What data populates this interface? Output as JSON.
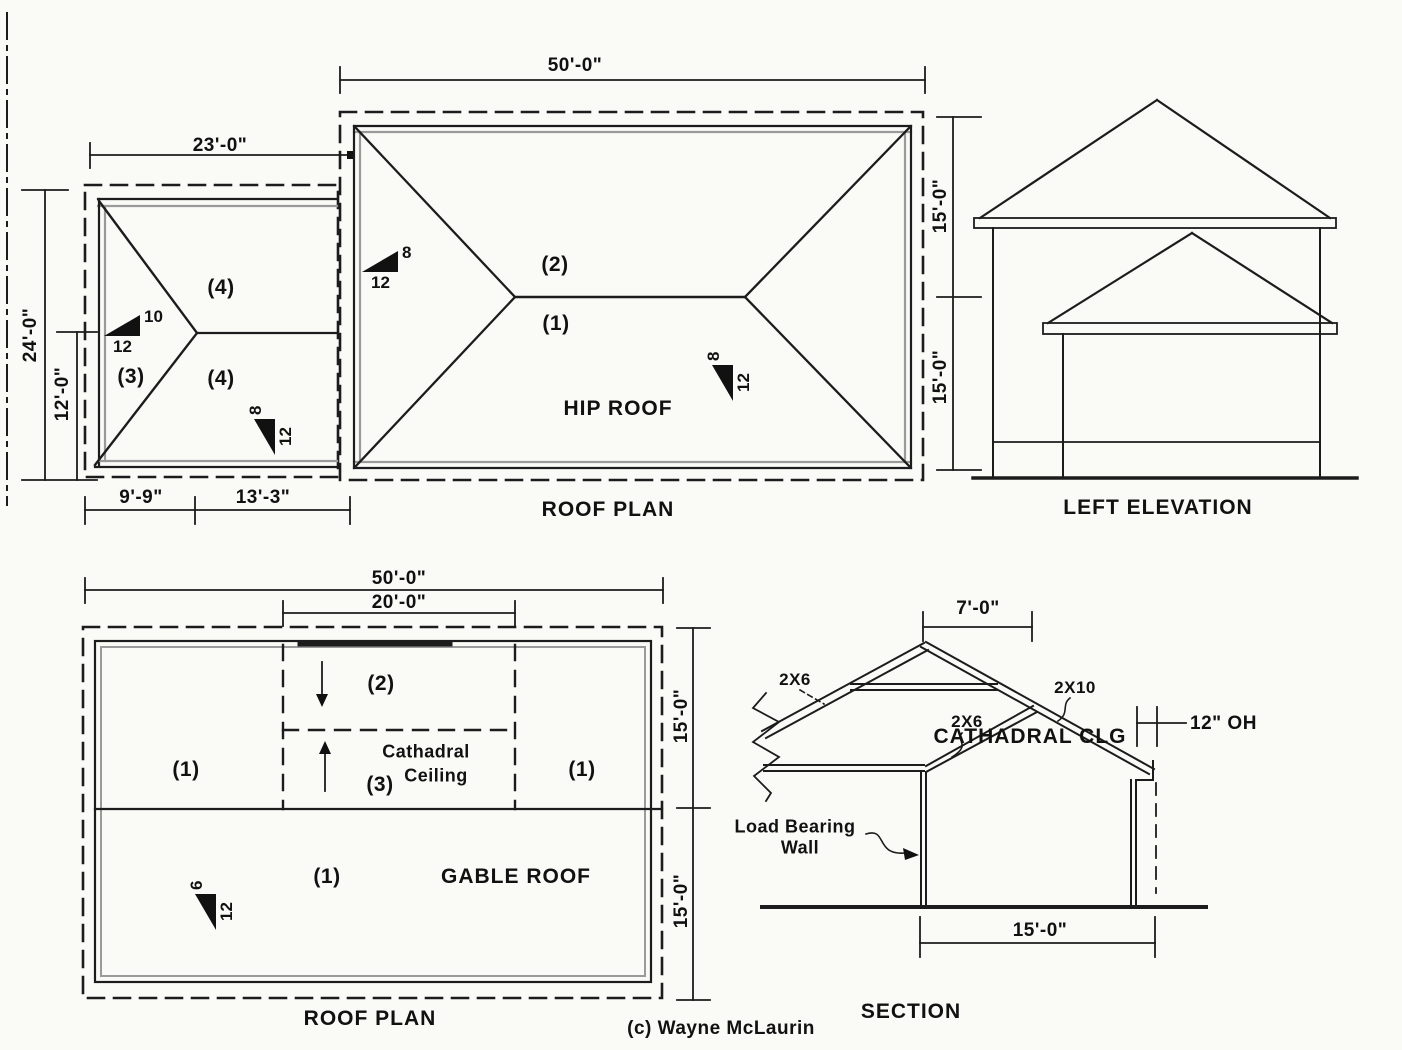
{
  "small_plan": {
    "dim_width": "23'-0\"",
    "dim_total_height": "24'-0\"",
    "dim_lower_height": "12'-0\"",
    "dim_bottom_left": "9'-9\"",
    "dim_bottom_right": "13'-3\"",
    "label_upper": "(4)",
    "label_left": "(3)",
    "label_lower": "(4)",
    "slope_upper": {
      "rise": "10",
      "run": "12"
    },
    "slope_lower": {
      "rise": "8",
      "run": "12"
    }
  },
  "hip_plan": {
    "title": "HIP ROOF",
    "caption": "ROOF PLAN",
    "dim_width": "50'-0\"",
    "dim_right_upper": "15'-0\"",
    "dim_right_lower": "15'-0\"",
    "label_upper": "(2)",
    "label_lower": "(1)",
    "slope_left": {
      "rise": "8",
      "run": "12"
    },
    "slope_right": {
      "rise": "8",
      "run": "12"
    }
  },
  "elevation": {
    "caption": "LEFT ELEVATION"
  },
  "gable_plan": {
    "title": "GABLE ROOF",
    "caption": "ROOF PLAN",
    "dim_width": "50'-0\"",
    "dim_cathedral_width": "20'-0\"",
    "dim_right_upper": "15'-0\"",
    "dim_right_lower": "15'-0\"",
    "label_upper_mid": "(2)",
    "label_left": "(1)",
    "label_right": "(1)",
    "label_cathedral_area": "(3)",
    "cathedral_line1": "Cathadral",
    "cathedral_line2": "Ceiling",
    "label_lower": "(1)",
    "slope": {
      "rise": "6",
      "run": "12"
    }
  },
  "section": {
    "caption": "SECTION",
    "dim_ridge_offset": "7'-0\"",
    "dim_span": "15'-0\"",
    "dim_overhang": "12\" OH",
    "label_left_rafter": "2X6",
    "label_ceiling_joist": "2X6",
    "label_right_rafter": "2X10",
    "label_cathedral": "CATHADRAL CLG",
    "label_wall_line1": "Load Bearing",
    "label_wall_line2": "Wall"
  },
  "copyright": "(c) Wayne McLaurin"
}
